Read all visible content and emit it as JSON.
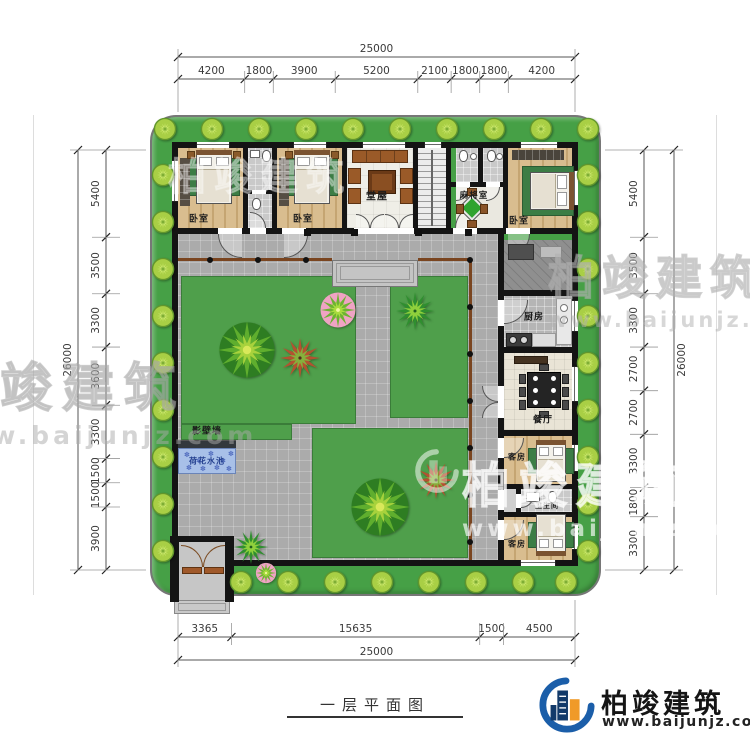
{
  "brand": {
    "name": "柏竣建筑",
    "url": "www.baijunjz.com"
  },
  "title": {
    "text": "一层平面图"
  },
  "dims": {
    "top": {
      "total": "25000",
      "segments": [
        "4200",
        "1800",
        "3900",
        "5200",
        "2100",
        "1800",
        "1800",
        "4200"
      ]
    },
    "bottom": {
      "total": "25000",
      "segments": [
        "3365",
        "15635",
        "1500",
        "4500"
      ]
    },
    "left": {
      "total": "26000",
      "segments": [
        "5400",
        "3500",
        "3300",
        "3600",
        "3300",
        "1500",
        "1500",
        "3900"
      ]
    },
    "right": {
      "total": "26000",
      "segments": [
        "5400",
        "3500",
        "3300",
        "2700",
        "2700",
        "3300",
        "1800",
        "3300"
      ]
    }
  },
  "rooms": {
    "bedroom_left": "卧室",
    "bedroom_mid": "卧室",
    "bedroom_right": "卧室",
    "hall": "堂屋",
    "mahjong": "麻将室",
    "kitchen": "厨房",
    "dining": "餐厅",
    "guest_upper": "客房",
    "guest_lower": "客房",
    "bathroom": "卫生间",
    "screen_wall": "影壁墙",
    "lotus_pond": "荷花水池"
  },
  "colors": {
    "hedge": "#46a046",
    "lawn": "#4f9f4b",
    "paving": "#ababab",
    "wall": "#141414",
    "wood_floor": "#d9bd8f",
    "water": "#a8c0e8",
    "railing": "#7a4520",
    "logo_blue": "#1b5ea9",
    "logo_orange": "#f09a28"
  }
}
